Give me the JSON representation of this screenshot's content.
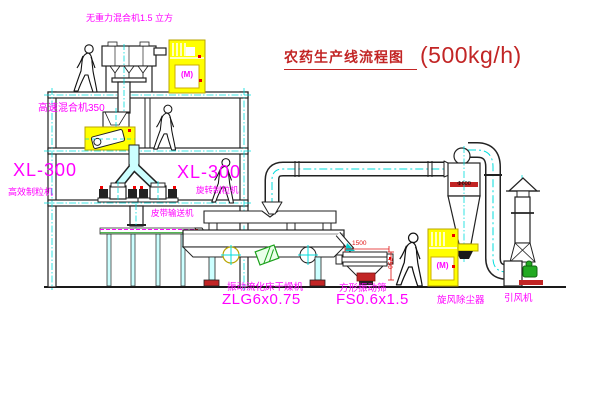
{
  "title": {
    "text_cn": "农药生产线流程图",
    "rate": "(500kg/h)"
  },
  "labels": {
    "gravity_mixer": "无重力混合机1.5 立方",
    "high_speed_mixer": "高速混合机350",
    "granulator_left_model": "XL-300",
    "granulator_left_name": "高效制粒机",
    "granulator_right_model": "XL-300",
    "granulator_right_name": "旋转制粒机",
    "belt_conveyor": "皮带输送机",
    "dryer_name": "振动流化床干燥机",
    "dryer_model": "ZLG6x0.75",
    "sieve_name": "方形振动筛",
    "sieve_model": "FS0.6x1.5",
    "cyclone_name": "旋风除尘器",
    "fan_name": "引风机"
  },
  "dimensions": {
    "sieve_width": "1500",
    "sieve_height": "750",
    "cyclone_diameter": "Φ600"
  },
  "cabinets": {
    "motor_text": "(M)"
  },
  "colors": {
    "label_magenta": "#ff00ff",
    "title_red": "#c22525",
    "dimension_red": "#e01111",
    "centerline_cyan": "#00dddd",
    "highlight_yellow": "#ffff00",
    "machine_green": "#1faa1f",
    "line_black": "#222222",
    "background": "#ffffff"
  }
}
